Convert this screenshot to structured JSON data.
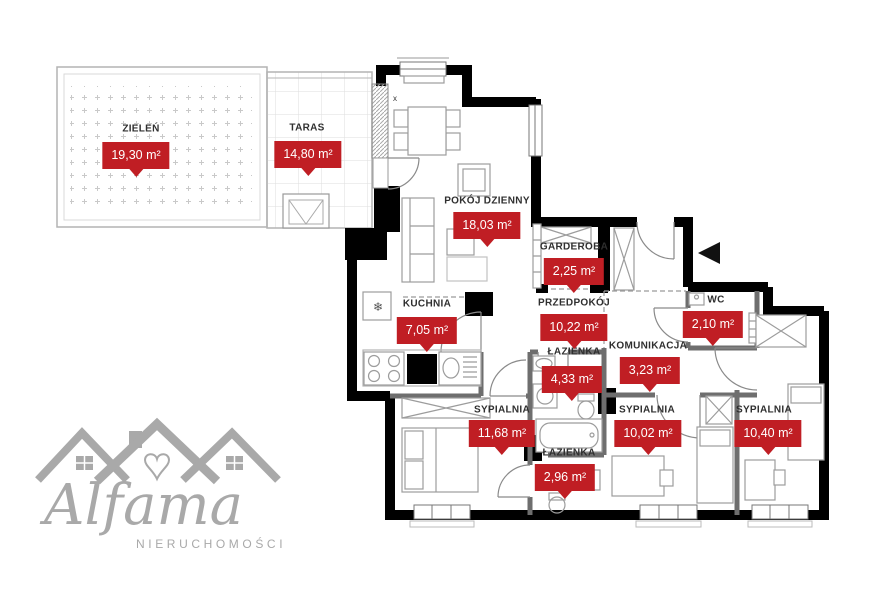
{
  "rooms": [
    {
      "id": "zielen",
      "name": "ZIELEŃ",
      "area": "19,30 m²"
    },
    {
      "id": "taras",
      "name": "TARAS",
      "area": "14,80 m²"
    },
    {
      "id": "pokoj-dzienny",
      "name": "POKÓJ DZIENNY",
      "area": "18,03 m²"
    },
    {
      "id": "garderoba",
      "name": "GARDEROBA",
      "area": "2,25 m²"
    },
    {
      "id": "przedpokoj",
      "name": "PRZEDPOKÓJ",
      "area": "10,22 m²"
    },
    {
      "id": "wc",
      "name": "WC",
      "area": "2,10 m²"
    },
    {
      "id": "kuchnia",
      "name": "KUCHNIA",
      "area": "7,05 m²"
    },
    {
      "id": "lazienka-1",
      "name": "ŁAZIENKA",
      "area": "4,33 m²"
    },
    {
      "id": "komunikacja",
      "name": "KOMUNIKACJA",
      "area": "3,23 m²"
    },
    {
      "id": "sypialnia-1",
      "name": "SYPIALNIA",
      "area": "11,68 m²"
    },
    {
      "id": "lazienka-2",
      "name": "ŁAZIENKA",
      "area": "2,96 m²"
    },
    {
      "id": "sypialnia-2",
      "name": "SYPIALNIA",
      "area": "10,02 m²"
    },
    {
      "id": "sypialnia-3",
      "name": "SYPIALNIA",
      "area": "10,40 m²"
    }
  ],
  "markers": {
    "window_x": "x",
    "fridge": "❄"
  },
  "logo": {
    "brand": "Alfama",
    "subtitle": "NIERUCHOMOŚCI"
  },
  "colors": {
    "badge_red": "#c01e24",
    "wall_black": "#000000",
    "logo_gray": "#a9a9a9"
  }
}
